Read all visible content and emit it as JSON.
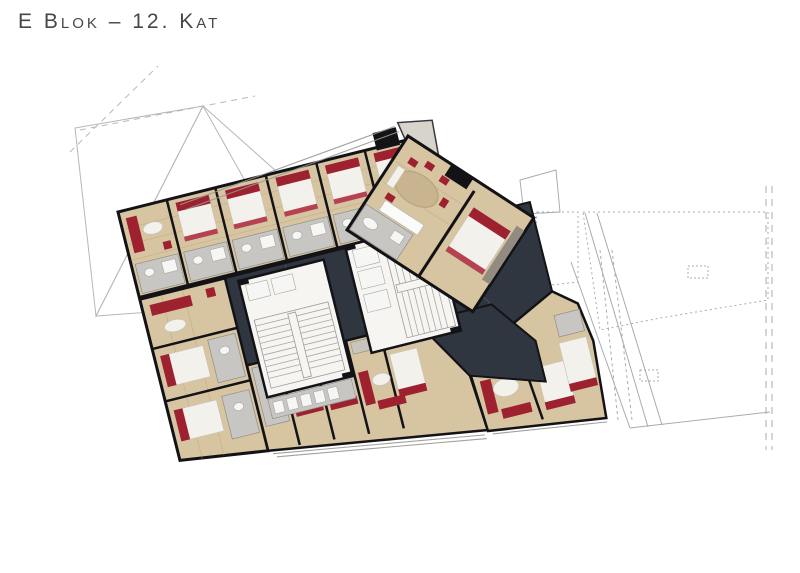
{
  "title": "E Blok – 12. Kat",
  "plan": {
    "block": "E Blok",
    "floor": "12. Kat",
    "kind": "residential-floor-plan-render"
  },
  "palette": {
    "corridor": "#30363f",
    "wall": "#131317",
    "wood": "#d7c5a2",
    "wood_dark": "#b59c72",
    "room_white": "#f3f1eb",
    "bath_gray": "#c7c6c2",
    "accent_red": "#9e2130",
    "accent_red2": "#b03340",
    "core_white": "#f6f5f2",
    "terrace": "#d6d4cb",
    "outline_gray": "#b4b8bb",
    "outline_gray2": "#a7acb0"
  }
}
